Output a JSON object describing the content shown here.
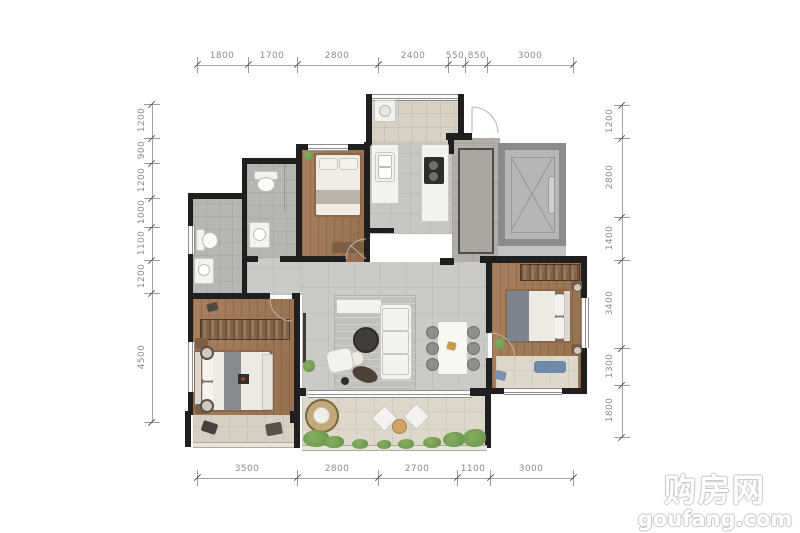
{
  "watermark": {
    "title": "购房网",
    "domain": "goufang.com"
  },
  "dimensions": {
    "top": [
      "1800",
      "1700",
      "2800",
      "2400",
      "550",
      "850",
      "3000"
    ],
    "bottom": [
      "3500",
      "2800",
      "2700",
      "1100",
      "3000"
    ],
    "left": [
      "1200",
      "900",
      "1200",
      "1000",
      "1100",
      "1200",
      "4500"
    ],
    "right": [
      "1200",
      "2800",
      "1400",
      "3400",
      "1300",
      "1800"
    ]
  },
  "colors": {
    "wall": "#1f1f1f",
    "wood_floor": "#a07c5c",
    "stone_tile": "#cbcac6",
    "bath_tile": "#b6b6b3",
    "balcony_tile": "#ded8ca",
    "utility_tile": "#d8d1c3",
    "corridor_tile": "#b1aea8",
    "elevator_wall": "#8c8c8c",
    "plant_green": "#6f9d52",
    "accent_blue": "#7188ad",
    "dimension_text": "#8c8c8c",
    "watermark_outline": "#c9c9c9"
  },
  "plan": {
    "type": "apartment-floor-plan",
    "rooms": [
      "utility-balcony",
      "kitchen",
      "entry-hall",
      "elevator",
      "bedroom-2",
      "bathroom-1",
      "bathroom-2",
      "living-dining-room",
      "master-bedroom",
      "bedroom-3",
      "living-balcony",
      "master-balcony"
    ]
  }
}
